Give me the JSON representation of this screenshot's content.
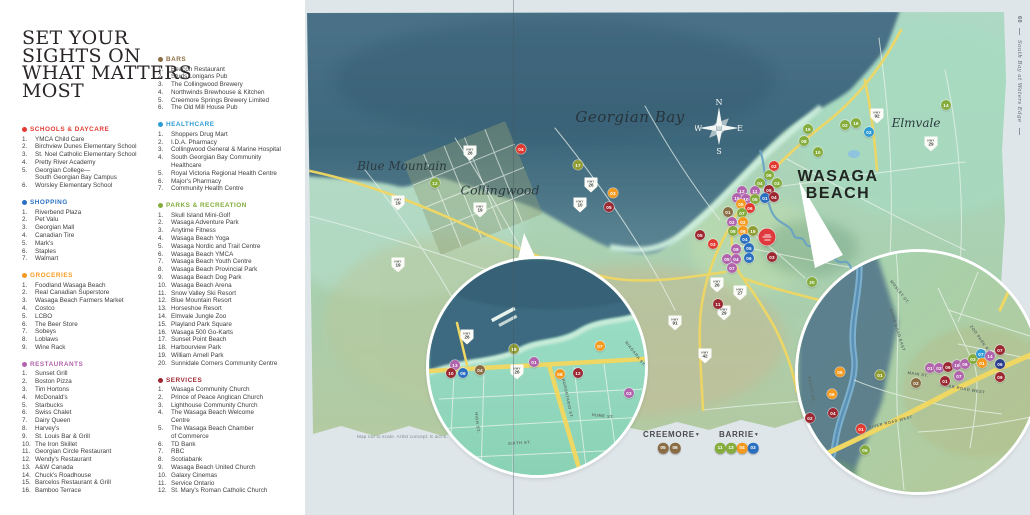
{
  "page": {
    "title_lines": [
      "SET YOUR",
      "SIGHTS ON",
      "WHAT MATTERS",
      "MOST"
    ],
    "sidebar": {
      "page_number": "60",
      "brochure_title": "South Bay at Waters Edge"
    },
    "note": "Map not to scale. Artist concept. E.&O.E."
  },
  "colors": {
    "schools": "#e23a30",
    "shopping": "#2a6fc0",
    "groceries": "#f49a1f",
    "restaurants": "#b164ad",
    "bars": "#8a6d44",
    "healthcare": "#2f9bd4",
    "healthcare_dark": "#2b3f8e",
    "parks": "#84ad3c",
    "parks_olive": "#8f9d33",
    "services": "#9c2832",
    "site": "#e0393d"
  },
  "legend": {
    "column1": [
      "schools",
      "shopping",
      "groceries",
      "restaurants"
    ],
    "column2": [
      "bars",
      "healthcare",
      "parks",
      "services"
    ],
    "categories": {
      "schools": {
        "label": "SCHOOLS & DAYCARE",
        "items": [
          "YMCA Child Care",
          "Birchview Dunes Elementary School",
          "St. Noel Catholic Elementary School",
          "Pretty River Academy",
          "Georgian College—\nSouth Georgian Bay Campus",
          "Worsley Elementary School"
        ]
      },
      "shopping": {
        "label": "SHOPPING",
        "items": [
          "Riverbend Plaza",
          "Pet Valu",
          "Georgian Mall",
          "Canadian Tire",
          "Mark's",
          "Staples",
          "Walmart"
        ]
      },
      "groceries": {
        "label": "GROCERIES",
        "items": [
          "Foodland Wasaga Beach",
          "Real Canadian Superstore",
          "Wasaga Beach Farmers Market",
          "Costco",
          "LCBO",
          "The Beer Store",
          "Sobeys",
          "Loblaws",
          "Wine Rack"
        ]
      },
      "restaurants": {
        "label": "RESTAURANTS",
        "items": [
          "Sunset Grill",
          "Boston Pizza",
          "Tim Hortons",
          "McDonald's",
          "Starbucks",
          "Swiss Chalet",
          "Dairy Queen",
          "Harvey's",
          "St. Louis Bar & Grill",
          "The Iron Skillet",
          "Georgian Circle Restaurant",
          "Wendy's Restaurant",
          "A&W Canada",
          "Chuck's Roadhouse",
          "Barcelos Restaurant & Grill",
          "Bamboo Terrace"
        ]
      },
      "bars": {
        "label": "BARS",
        "items": [
          "Beacon Restaurant",
          "Studs Lonigans Pub",
          "The Collingwood Brewery",
          "Northwinds Brewhouse & Kitchen",
          "Creemore Springs Brewery Limited",
          "The Old Mill House Pub"
        ]
      },
      "healthcare": {
        "label": "HEALTHCARE",
        "items": [
          "Shoppers Drug Mart",
          "I.D.A. Pharmacy",
          "Collingwood General & Marine Hospital",
          "South Georgian Bay Community\nHealthcare",
          "Royal Victoria Regional Health Centre",
          "Major's Pharmacy",
          "Community Health Centre"
        ]
      },
      "parks": {
        "label": "PARKS & RECREATION",
        "items": [
          "Skull Island Mini-Golf",
          "Wasaga Adventure Park",
          "Anytime Fitness",
          "Wasaga Beach Yoga",
          "Wasaga Nordic and Trail Centre",
          "Wasaga Beach YMCA",
          "Wasaga Beach Youth Centre",
          "Wasaga Beach Provincial Park",
          "Wasaga Beach Dog Park",
          "Wasaga Beach Arena",
          "Snow Valley Ski Resort",
          "Blue Mountain Resort",
          "Horseshoe Resort",
          "Elmvale Jungle Zoo",
          "Playland Park Square",
          "Wasaga 500 Go-Karts",
          "Sunset Point Beach",
          "Harbourview Park",
          "William Arnell Park",
          "Sunnidale Corners Community Centre"
        ]
      },
      "services": {
        "label": "SERVICES",
        "items": [
          "Wasaga Community Church",
          "Prince of Peace Anglican Church",
          "Lighthouse Community Church",
          "The Wasaga Beach Welcome\nCentre",
          "The Wasaga Beach Chamber\nof Commerce",
          "TD Bank",
          "RBC",
          "Scotiabank",
          "Wasaga Beach United Church",
          "Galaxy Cinemas",
          "Service Ontario",
          "St. Mary's Roman Catholic Church"
        ]
      }
    }
  },
  "map": {
    "compass": {
      "n": "N",
      "e": "E",
      "s": "S",
      "w": "W"
    },
    "shield_prefix": "HWY",
    "place_labels": [
      {
        "id": "georgian-bay",
        "text": "Georgian Bay",
        "x": 630,
        "y": 117,
        "cls": "pl-serif pl-georgian-bay"
      },
      {
        "id": "blue-mountain",
        "text": "Blue Mountain",
        "x": 402,
        "y": 166,
        "cls": "pl-serif pl-blue-mountain"
      },
      {
        "id": "collingwood",
        "text": "Collingwood",
        "x": 500,
        "y": 190,
        "cls": "pl-serif pl-collingwood"
      },
      {
        "id": "elmvale",
        "text": "Elmvale",
        "x": 916,
        "y": 123,
        "cls": "pl-serif pl-elmvale"
      },
      {
        "id": "wasaga-beach",
        "text": "WASAGA\nBEACH",
        "x": 838,
        "y": 185,
        "cls": "pl-wasaga-beach"
      }
    ],
    "streets": [
      {
        "text": "NIAGARA ST.",
        "x": 628,
        "y": 340,
        "rot": 52
      },
      {
        "text": "HURONTARIO ST.",
        "x": 566,
        "y": 378,
        "rot": 78
      },
      {
        "text": "HUME ST.",
        "x": 592,
        "y": 412,
        "rot": 6
      },
      {
        "text": "SIXTH ST.",
        "x": 508,
        "y": 441,
        "rot": -4
      },
      {
        "text": "HIGH ST.",
        "x": 479,
        "y": 412,
        "rot": 84
      },
      {
        "text": "MOSLEY ST.",
        "x": 893,
        "y": 279,
        "rot": 52
      },
      {
        "text": "RIVER ROAD EAST",
        "x": 893,
        "y": 308,
        "rot": 72
      },
      {
        "text": "ZOO PARK ROAD",
        "x": 973,
        "y": 324,
        "rot": 55
      },
      {
        "text": "MAIN ST.",
        "x": 908,
        "y": 370,
        "rot": 8
      },
      {
        "text": "RIVER ROAD WEST",
        "x": 941,
        "y": 382,
        "rot": 10
      },
      {
        "text": "RIVER ROAD WEST",
        "x": 868,
        "y": 425,
        "rot": -14
      },
      {
        "text": "BEACH DR.",
        "x": 812,
        "y": 376,
        "rot": 80
      }
    ],
    "shields": [
      {
        "n": "26",
        "x": 470,
        "y": 153
      },
      {
        "n": "19",
        "x": 398,
        "y": 203
      },
      {
        "n": "19",
        "x": 480,
        "y": 210
      },
      {
        "n": "19",
        "x": 398,
        "y": 265
      },
      {
        "n": "26",
        "x": 591,
        "y": 185
      },
      {
        "n": "10",
        "x": 580,
        "y": 205
      },
      {
        "n": "92",
        "x": 877,
        "y": 116
      },
      {
        "n": "29",
        "x": 931,
        "y": 144
      },
      {
        "n": "26",
        "x": 717,
        "y": 285
      },
      {
        "n": "27",
        "x": 740,
        "y": 293
      },
      {
        "n": "91",
        "x": 675,
        "y": 323
      },
      {
        "n": "42",
        "x": 705,
        "y": 356
      },
      {
        "n": "29",
        "x": 724,
        "y": 313
      },
      {
        "n": "26",
        "x": 467,
        "y": 337
      },
      {
        "n": "26",
        "x": 517,
        "y": 372
      }
    ],
    "site_marker": {
      "x": 767,
      "y": 237
    },
    "markers": [
      {
        "c": "parks",
        "n": "17",
        "x": 578,
        "y": 165,
        "col": "parks_olive"
      },
      {
        "c": "groceries",
        "n": "03",
        "x": 613,
        "y": 193
      },
      {
        "c": "services",
        "n": "05",
        "x": 609,
        "y": 207
      },
      {
        "c": "schools",
        "n": "04",
        "x": 521,
        "y": 149
      },
      {
        "c": "parks",
        "n": "12",
        "x": 435,
        "y": 183
      },
      {
        "c": "parks",
        "n": "15",
        "x": 808,
        "y": 129
      },
      {
        "c": "parks",
        "n": "02",
        "x": 845,
        "y": 125
      },
      {
        "c": "parks",
        "n": "16",
        "x": 856,
        "y": 123
      },
      {
        "c": "healthcare",
        "n": "02",
        "x": 869,
        "y": 132
      },
      {
        "c": "parks",
        "n": "08",
        "x": 804,
        "y": 141
      },
      {
        "c": "parks",
        "n": "10",
        "x": 818,
        "y": 152
      },
      {
        "c": "parks",
        "n": "14",
        "x": 946,
        "y": 105
      },
      {
        "c": "parks",
        "n": "20",
        "x": 812,
        "y": 282
      },
      {
        "c": "schools",
        "n": "02",
        "x": 774,
        "y": 166
      },
      {
        "c": "parks",
        "n": "09",
        "x": 769,
        "y": 175
      },
      {
        "c": "parks",
        "n": "04",
        "x": 760,
        "y": 183
      },
      {
        "c": "parks",
        "n": "03",
        "x": 777,
        "y": 183
      },
      {
        "c": "services",
        "n": "09",
        "x": 769,
        "y": 190
      },
      {
        "c": "restaurants",
        "n": "12",
        "x": 742,
        "y": 191
      },
      {
        "c": "restaurants",
        "n": "11",
        "x": 755,
        "y": 191
      },
      {
        "c": "restaurants",
        "n": "15",
        "x": 737,
        "y": 198
      },
      {
        "c": "restaurants",
        "n": "10",
        "x": 746,
        "y": 199
      },
      {
        "c": "parks",
        "n": "05",
        "x": 755,
        "y": 199
      },
      {
        "c": "shopping",
        "n": "01",
        "x": 765,
        "y": 198
      },
      {
        "c": "services",
        "n": "04",
        "x": 774,
        "y": 197
      },
      {
        "c": "bars",
        "n": "01",
        "x": 728,
        "y": 212
      },
      {
        "c": "groceries",
        "n": "05",
        "x": 741,
        "y": 204
      },
      {
        "c": "schools",
        "n": "06",
        "x": 750,
        "y": 208
      },
      {
        "c": "parks",
        "n": "07",
        "x": 742,
        "y": 213
      },
      {
        "c": "restaurants",
        "n": "02",
        "x": 732,
        "y": 222
      },
      {
        "c": "groceries",
        "n": "02",
        "x": 743,
        "y": 222
      },
      {
        "c": "parks",
        "n": "08",
        "x": 733,
        "y": 231
      },
      {
        "c": "groceries",
        "n": "09",
        "x": 743,
        "y": 231
      },
      {
        "c": "parks",
        "n": "19",
        "x": 753,
        "y": 231,
        "col": "parks_olive"
      },
      {
        "c": "services",
        "n": "05",
        "x": 700,
        "y": 235
      },
      {
        "c": "schools",
        "n": "03",
        "x": 713,
        "y": 244
      },
      {
        "c": "shopping",
        "n": "04",
        "x": 745,
        "y": 239
      },
      {
        "c": "restaurants",
        "n": "09",
        "x": 736,
        "y": 249
      },
      {
        "c": "shopping",
        "n": "05",
        "x": 749,
        "y": 248
      },
      {
        "c": "restaurants",
        "n": "05",
        "x": 727,
        "y": 259
      },
      {
        "c": "restaurants",
        "n": "04",
        "x": 736,
        "y": 259
      },
      {
        "c": "shopping",
        "n": "06",
        "x": 749,
        "y": 258
      },
      {
        "c": "restaurants",
        "n": "07",
        "x": 732,
        "y": 268
      },
      {
        "c": "services",
        "n": "03",
        "x": 772,
        "y": 257
      },
      {
        "c": "services",
        "n": "11",
        "x": 718,
        "y": 304
      },
      {
        "c": "parks",
        "n": "18",
        "x": 514,
        "y": 349,
        "col": "parks_olive"
      },
      {
        "c": "restaurants",
        "n": "01",
        "x": 534,
        "y": 362
      },
      {
        "c": "groceries",
        "n": "07",
        "x": 600,
        "y": 346
      },
      {
        "c": "restaurants",
        "n": "13",
        "x": 455,
        "y": 365
      },
      {
        "c": "services",
        "n": "10",
        "x": 451,
        "y": 373
      },
      {
        "c": "shopping",
        "n": "06",
        "x": 463,
        "y": 373
      },
      {
        "c": "bars",
        "n": "04",
        "x": 480,
        "y": 370
      },
      {
        "c": "groceries",
        "n": "08",
        "x": 560,
        "y": 374
      },
      {
        "c": "services",
        "n": "12",
        "x": 578,
        "y": 373
      },
      {
        "c": "restaurants",
        "n": "03",
        "x": 629,
        "y": 393
      },
      {
        "c": "groceries",
        "n": "05",
        "x": 840,
        "y": 372
      },
      {
        "c": "parks",
        "n": "01",
        "x": 880,
        "y": 375,
        "col": "parks_olive"
      },
      {
        "c": "groceries",
        "n": "06",
        "x": 832,
        "y": 394
      },
      {
        "c": "services",
        "n": "04",
        "x": 833,
        "y": 413
      },
      {
        "c": "services",
        "n": "02",
        "x": 810,
        "y": 418
      },
      {
        "c": "schools",
        "n": "01",
        "x": 861,
        "y": 429
      },
      {
        "c": "parks",
        "n": "05",
        "x": 865,
        "y": 450
      },
      {
        "c": "bars",
        "n": "02",
        "x": 916,
        "y": 383
      },
      {
        "c": "services",
        "n": "01",
        "x": 945,
        "y": 381
      },
      {
        "c": "restaurants",
        "n": "07",
        "x": 959,
        "y": 376
      },
      {
        "c": "restaurants",
        "n": "01",
        "x": 930,
        "y": 368
      },
      {
        "c": "restaurants",
        "n": "02",
        "x": 939,
        "y": 368
      },
      {
        "c": "services",
        "n": "06",
        "x": 948,
        "y": 367
      },
      {
        "c": "restaurants",
        "n": "16",
        "x": 957,
        "y": 365
      },
      {
        "c": "restaurants",
        "n": "06",
        "x": 965,
        "y": 364
      },
      {
        "c": "parks",
        "n": "03",
        "x": 973,
        "y": 359
      },
      {
        "c": "healthcare",
        "n": "07",
        "x": 981,
        "y": 354
      },
      {
        "c": "groceries",
        "n": "01",
        "x": 982,
        "y": 363
      },
      {
        "c": "restaurants",
        "n": "14",
        "x": 990,
        "y": 356
      },
      {
        "c": "services",
        "n": "07",
        "x": 1000,
        "y": 350
      },
      {
        "c": "healthcare",
        "n": "06",
        "x": 1000,
        "y": 364,
        "col": "healthcare_dark"
      },
      {
        "c": "services",
        "n": "09",
        "x": 1000,
        "y": 377
      }
    ],
    "city_legends": [
      {
        "name": "CREEMORE",
        "arrow": "▼",
        "x": 643,
        "y": 430,
        "chips": [
          {
            "c": "bars",
            "n": "05",
            "x": 663,
            "y": 448
          },
          {
            "c": "bars",
            "n": "06",
            "x": 675,
            "y": 448
          }
        ]
      },
      {
        "name": "BARRIE",
        "arrow": "▼",
        "x": 719,
        "y": 430,
        "chips": [
          {
            "c": "parks",
            "n": "11",
            "x": 720,
            "y": 448
          },
          {
            "c": "parks",
            "n": "13",
            "x": 731,
            "y": 448
          },
          {
            "c": "groceries",
            "n": "04",
            "x": 742,
            "y": 448
          },
          {
            "c": "shopping",
            "n": "03",
            "x": 753,
            "y": 448
          }
        ]
      }
    ],
    "note_pos": {
      "x": 357,
      "y": 434
    }
  }
}
